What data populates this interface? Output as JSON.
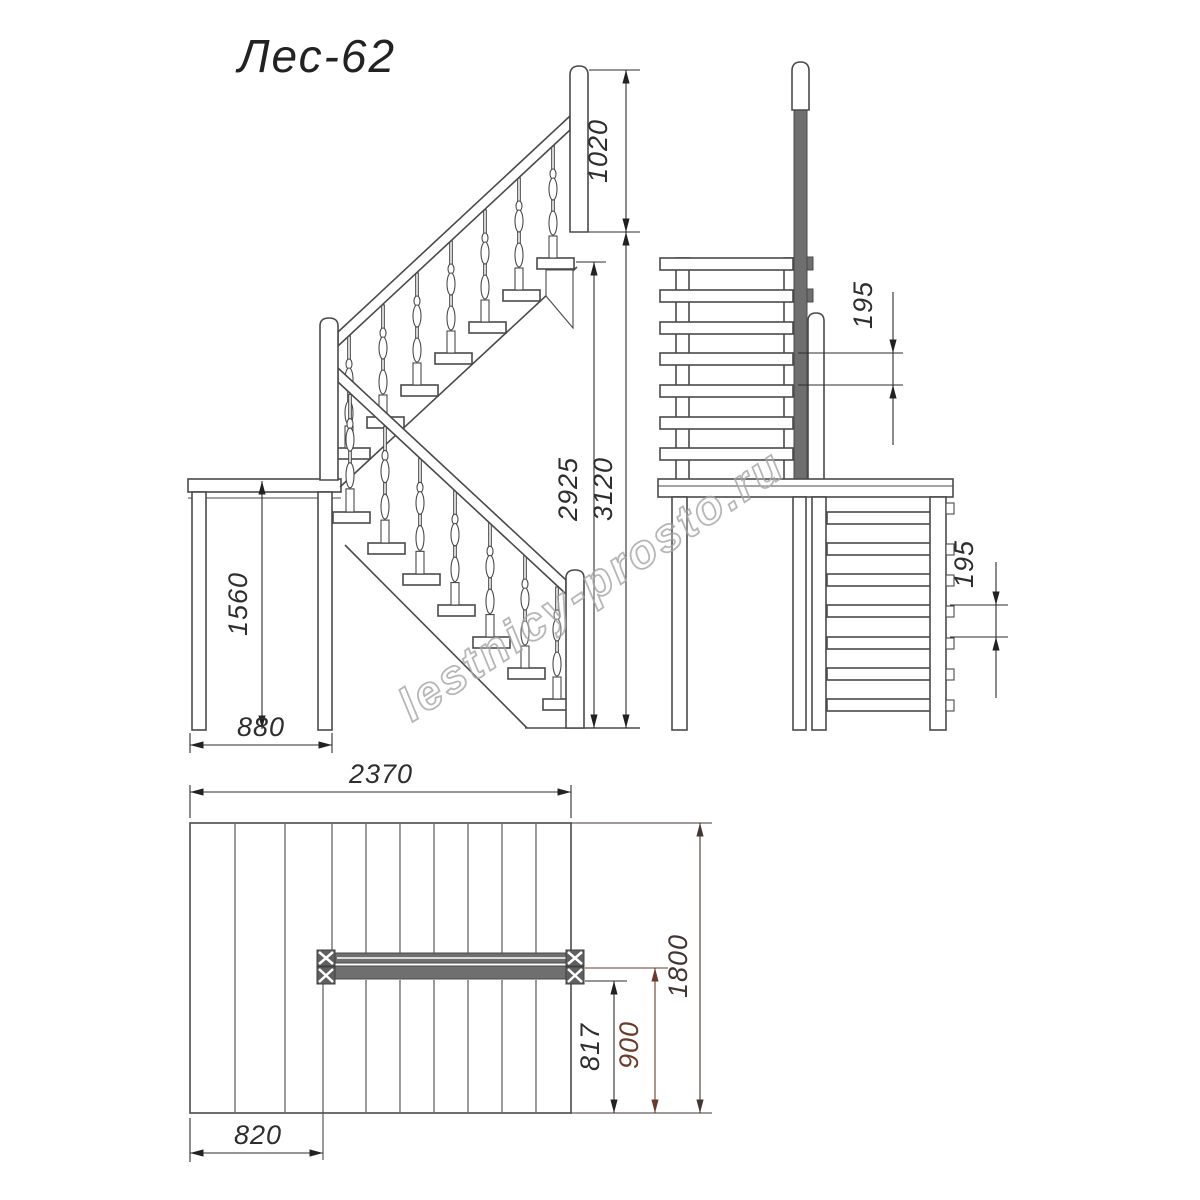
{
  "title": "Лес-62",
  "watermark": "lestnicy-prosto.ru",
  "drawing_type": "staircase technical drawing, three orthographic views",
  "colors": {
    "line": "#4a4a4a",
    "dimension": "#2e2e2e",
    "dimension_900": "#6e3a28",
    "dimension_1800": "#453530",
    "handrail_fill": "#6f6f6f",
    "watermark": "#a5a5a5"
  },
  "views": {
    "side_elevation": {
      "name": "side elevation",
      "dims": {
        "railing_height": "1020",
        "platform_clear_height": "2925",
        "total_height": "3120",
        "landing_height": "1560",
        "landing_depth": "880"
      }
    },
    "front_elevation": {
      "name": "front elevation",
      "dims": {
        "upper_flight_step_rise": "195",
        "lower_flight_step_rise": "195"
      }
    },
    "plan": {
      "name": "plan view",
      "dims": {
        "total_length": "2370",
        "landing_length": "820",
        "total_width": "1800",
        "lower_flight_offset": "900",
        "flight_width": "817"
      }
    }
  }
}
